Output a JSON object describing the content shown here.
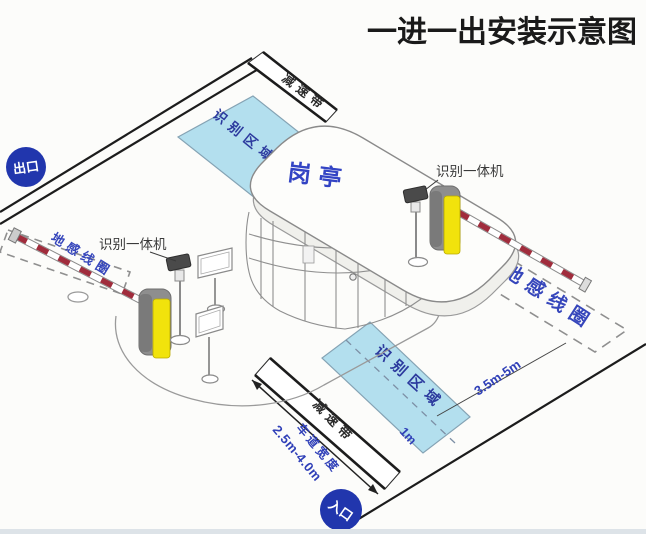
{
  "title": "一进一出安装示意图",
  "badges": {
    "exit": "出口",
    "entrance": "入口"
  },
  "booth": {
    "label": "岗亭"
  },
  "exit_lane": {
    "speed_bump": "减速带",
    "recognition_area": "识别区域",
    "ground_loop": "地感线圈",
    "camera_label": "识别一体机"
  },
  "entry_lane": {
    "speed_bump": "减速带",
    "recognition_area": "识别区域",
    "ground_loop": "地感线圈",
    "camera_label": "识别一体机",
    "lane_width_label": "车道宽度",
    "lane_width_value": "2.5m-4.0m",
    "loop_distance": "3.5m-5m",
    "area_offset": "1m"
  },
  "colors": {
    "badge_blue": "#2136ad",
    "label_blue": "#2c3a9e",
    "measure_blue": "#3040b8",
    "area_fill": "#b3dfee",
    "barrier_red": "#a02c3c",
    "machine_yellow": "#f1e30c",
    "machine_gray": "#8e8e8e",
    "line_black": "#1c1c1c"
  }
}
